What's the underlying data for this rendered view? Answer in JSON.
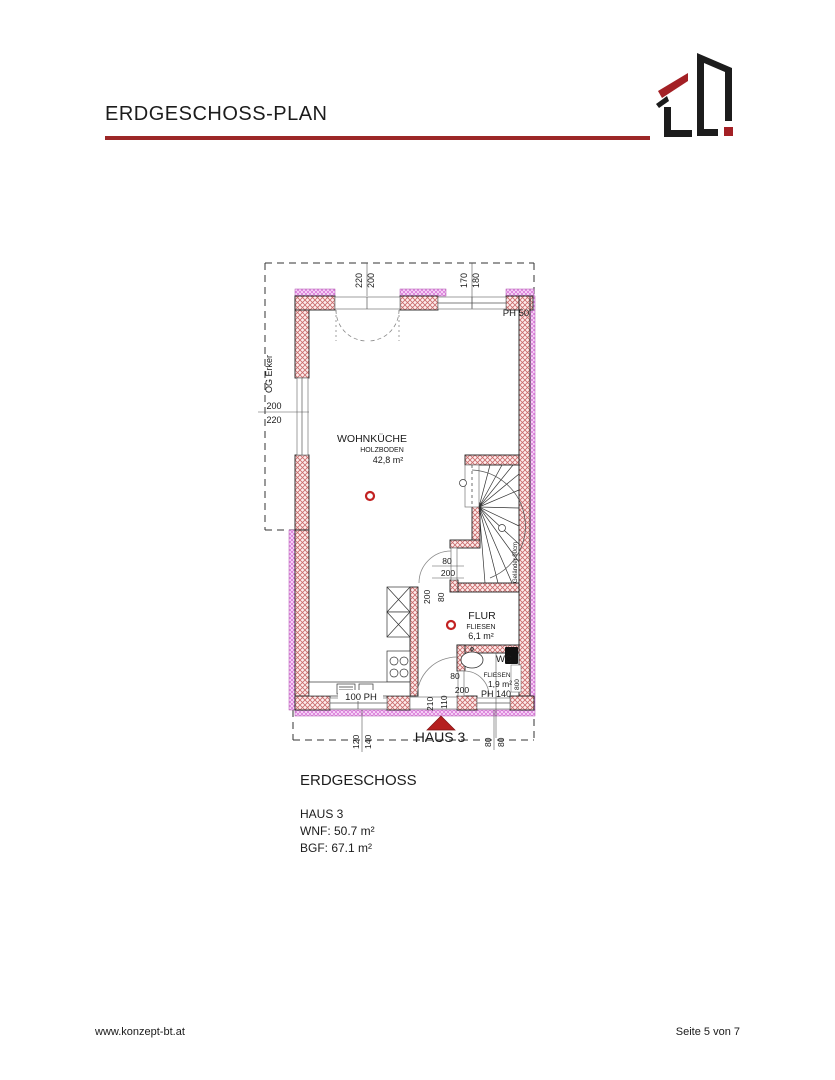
{
  "header": {
    "title": "ERDGESCHOSS-PLAN"
  },
  "plan": {
    "boundary_label": "OG Erker",
    "house_label": "HAUS 3",
    "rooms": {
      "wohnkueche": {
        "name": "WOHNKÜCHE",
        "floor": "HOLZBODEN",
        "area": "42,8 m²"
      },
      "flur": {
        "name": "FLUR",
        "floor": "FLIESEN",
        "area": "6,1 m²"
      },
      "wc": {
        "name": "WC",
        "floor": "FLIESEN",
        "area": "1,9 m²"
      }
    },
    "dims": {
      "top_door_1": "220",
      "top_door_2": "200",
      "top_win_1": "170",
      "top_win_2": "180",
      "ph50": "PH 50",
      "left_win_1": "200",
      "left_win_2": "220",
      "stair_door_w": "80",
      "stair_door_h": "200",
      "flur_door_h": "200",
      "flur_door_w": "80",
      "wc_door_w": "80",
      "wc_door_h": "200",
      "ph140": "PH 140",
      "kitchen_ph": "100 PH",
      "entry_1": "210",
      "entry_2": "110",
      "bottom_1": "120",
      "bottom_2": "140",
      "bottom_3": "80",
      "bottom_4": "80",
      "wc_side": "800",
      "gelaender": "Geländer 90cm"
    }
  },
  "summary": {
    "heading": "ERDGESCHOSS",
    "line1": "HAUS 3",
    "line2": "WNF: 50.7 m²",
    "line3": "BGF: 67.1 m²"
  },
  "footer": {
    "left": "www.konzept-bt.at",
    "right": "Seite 5 von 7"
  },
  "colors": {
    "accent_red": "#9c2727",
    "wall_hatch": "#c96a6a",
    "og_hatch": "#d46fd4",
    "symbol_red": "#c22222"
  }
}
